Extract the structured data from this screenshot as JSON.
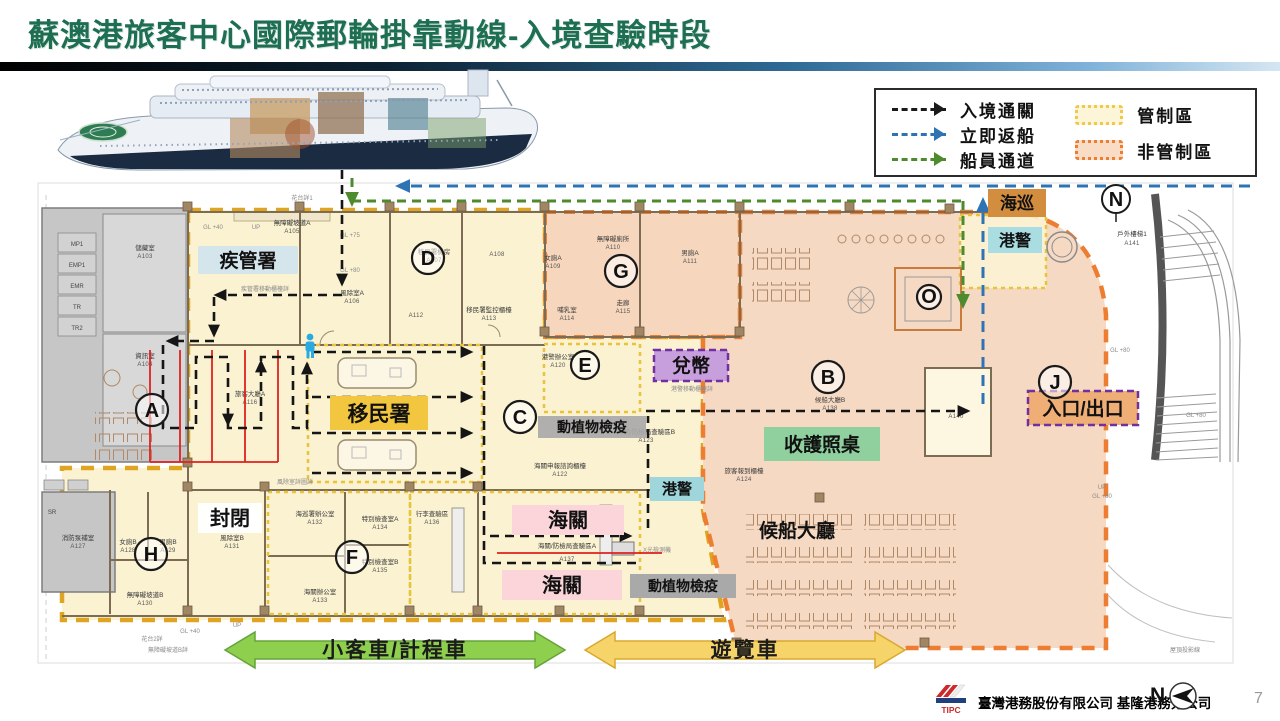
{
  "slide": {
    "title": "蘇澳港旅客中心國際郵輪掛靠動線-入境查驗時段",
    "title_color": "#1e6e52",
    "page_number": "7",
    "footer_company": "臺灣港務股份有限公司 基隆港務分公司",
    "logo_text": "TIPC",
    "footer_compass": "N"
  },
  "legend": {
    "flows": [
      {
        "label": "入境通關",
        "color": "#1a1a1a"
      },
      {
        "label": "立即返船",
        "color": "#2e74b5"
      },
      {
        "label": "船員通道",
        "color": "#4e8a2e"
      }
    ],
    "zones": [
      {
        "label": "管制區",
        "fill": "#fbf2d2",
        "border": "#f0c84c"
      },
      {
        "label": "非管制區",
        "fill": "#f6d9c3",
        "border": "#ed7d31"
      }
    ]
  },
  "plan": {
    "compass_n": "N",
    "zone_letters": [
      "A",
      "B",
      "C",
      "D",
      "E",
      "F",
      "G",
      "H",
      "J",
      "O"
    ],
    "labels": [
      {
        "key": "cdc",
        "text": "疾管署",
        "bg": "#cfe3ef"
      },
      {
        "key": "immigration",
        "text": "移民署",
        "bg": "#f3c63f"
      },
      {
        "key": "closed",
        "text": "封閉",
        "bg": "#ffffff"
      },
      {
        "key": "customs-upper",
        "text": "海關",
        "bg": "#fbd5da"
      },
      {
        "key": "customs-lower",
        "text": "海關",
        "bg": "#fbd5da"
      },
      {
        "key": "quarantine-mid",
        "text": "動植物檢疫",
        "bg": "#a9a9a9"
      },
      {
        "key": "quarantine-lower",
        "text": "動植物檢疫",
        "bg": "#a9a9a9"
      },
      {
        "key": "port-police-mid",
        "text": "港警",
        "bg": "#9ed6dc"
      },
      {
        "key": "port-police-top",
        "text": "港警",
        "bg": "#aadde2"
      },
      {
        "key": "coast-guard",
        "text": "海巡",
        "bg": "#d28d3f"
      },
      {
        "key": "currency-exchange",
        "text": "兌幣",
        "bg": "#c89fdd",
        "border": "#7030a0"
      },
      {
        "key": "passport-desk",
        "text": "收護照桌",
        "bg": "#90cf9e"
      },
      {
        "key": "waiting-hall",
        "text": "候船大廳",
        "color": "#2e74b5"
      },
      {
        "key": "entrance-exit",
        "text": "入口/出口",
        "bg": "#f0ae77",
        "border": "#7030a0"
      }
    ],
    "rooms": [
      {
        "id": "A103",
        "name": "儲藏室"
      },
      {
        "id": "A104",
        "name": "資訊室"
      },
      {
        "id": "A105",
        "name": "無障礙坡道A"
      },
      {
        "id": "A106",
        "name": "風除室A"
      },
      {
        "id": "A107",
        "name": "移民署機房"
      },
      {
        "id": "A108",
        "name": ""
      },
      {
        "id": "A109",
        "name": "女廁A"
      },
      {
        "id": "A110",
        "name": "無障礙廁所"
      },
      {
        "id": "A111",
        "name": "男廁A"
      },
      {
        "id": "A112",
        "name": ""
      },
      {
        "id": "A113",
        "name": "移民署監控櫃檯"
      },
      {
        "id": "A114",
        "name": "哺乳室"
      },
      {
        "id": "A115",
        "name": "走廊"
      },
      {
        "id": "A116",
        "name": "旅客大廳A"
      },
      {
        "id": "A120",
        "name": "港警辦公室"
      },
      {
        "id": "A122",
        "name": "海關申報諮詢櫃檯"
      },
      {
        "id": "A123",
        "name": "海關/防檢局查驗區B"
      },
      {
        "id": "A124",
        "name": "旅客報到櫃檯"
      },
      {
        "id": "A127",
        "name": "消防泵補室"
      },
      {
        "id": "A128",
        "name": "女廁B"
      },
      {
        "id": "A129",
        "name": "男廁B"
      },
      {
        "id": "A130",
        "name": "無障礙坡道B"
      },
      {
        "id": "A131",
        "name": "風除室B"
      },
      {
        "id": "A132",
        "name": "海巡署辦公室"
      },
      {
        "id": "A133",
        "name": "海關辦公室"
      },
      {
        "id": "A134",
        "name": "特別檢查室A"
      },
      {
        "id": "A135",
        "name": "特別檢查室B"
      },
      {
        "id": "A136",
        "name": "行李查驗區"
      },
      {
        "id": "A137",
        "name": "海關/防檢局查驗區A"
      },
      {
        "id": "A138",
        "name": "候船大廳B"
      },
      {
        "id": "A140",
        "name": ""
      },
      {
        "id": "A141",
        "name": "戶外樓梯1"
      }
    ],
    "utility_cells": [
      "MP1",
      "EMP1",
      "EMR",
      "TR",
      "TR2",
      "SR"
    ],
    "notes": [
      "UP",
      "GL +40",
      "花台詳1",
      "疾管署移動櫃檯詳",
      "GL +75",
      "GL +80",
      "風除室詳圖詳",
      "港警移動櫃檯詳",
      "X光檢測機",
      "UP",
      "GL +40",
      "花台2詳",
      "無障礙坡道B詳",
      "UP",
      "GL +80",
      "GL +80",
      "GL +80",
      "屋頂投影線"
    ]
  },
  "bottom_arrows": [
    {
      "label": "小客車/計程車",
      "color": "#8ed04e"
    },
    {
      "label": "遊覽車",
      "color": "#f6d46a"
    }
  ]
}
